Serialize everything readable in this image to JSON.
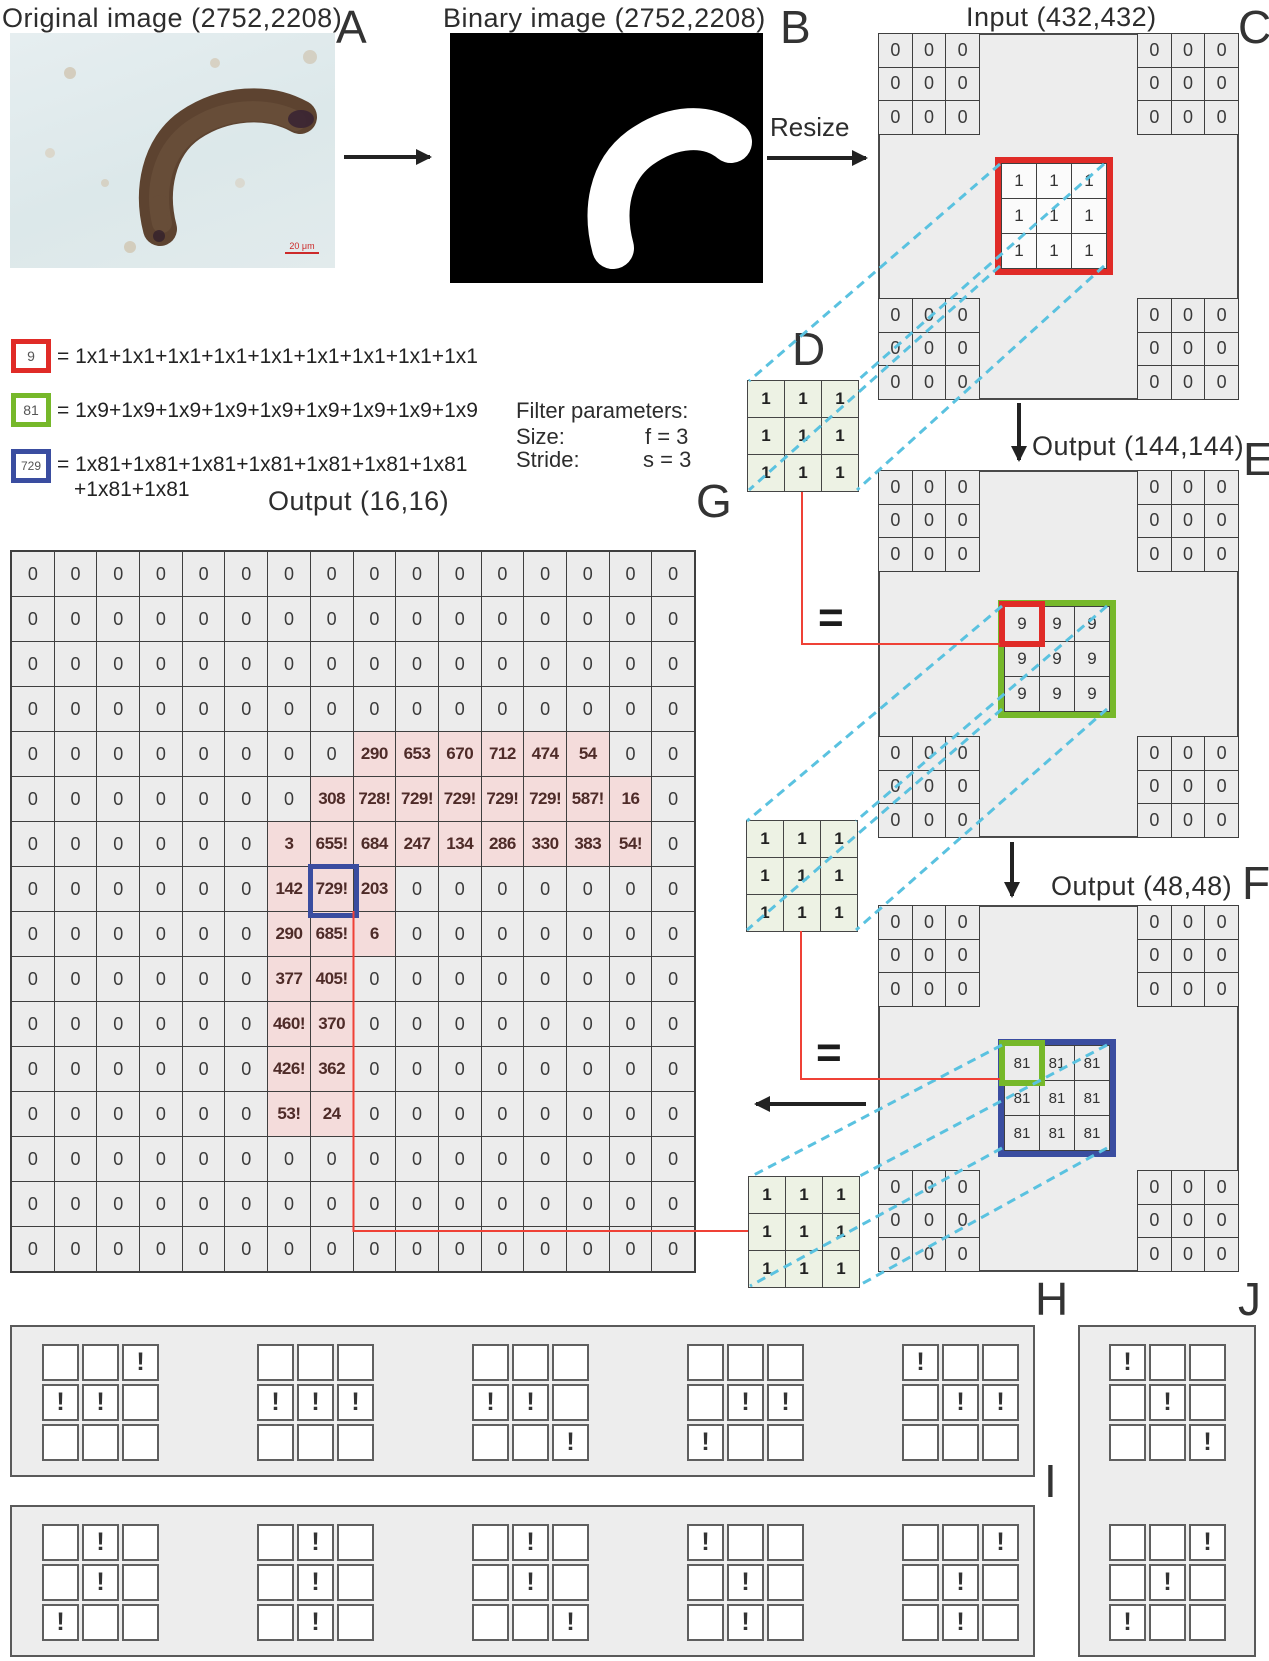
{
  "colors": {
    "red": "#e02b27",
    "green": "#76b82a",
    "blue": "#3a4da0",
    "dash": "#5ac2e0",
    "redline": "#ef4136",
    "filterbg": "#edf2e4",
    "pink": "#f4dcdb"
  },
  "exclamation": "!",
  "panel_a": {
    "title": "Original image (2752,2208)",
    "label": "A",
    "scale_bar_label": "20 μm"
  },
  "panel_b": {
    "title": "Binary image (2752,2208)",
    "label": "B"
  },
  "resize": {
    "label": "Resize"
  },
  "panel_c": {
    "title": "Input (432,432)",
    "label": "C",
    "corner_value": "0",
    "center_value": "1"
  },
  "filter_d": {
    "label": "D"
  },
  "filters_bank": {
    "value": "1"
  },
  "filter_params": {
    "heading": "Filter parameters:",
    "size_label": "Size:",
    "size_value": "f = 3",
    "stride_label": "Stride:",
    "stride_value": "s = 3"
  },
  "legend": {
    "items": [
      {
        "box": "9",
        "equation": "= 1x1+1x1+1x1+1x1+1x1+1x1+1x1+1x1+1x1"
      },
      {
        "box": "81",
        "equation": "= 1x9+1x9+1x9+1x9+1x9+1x9+1x9+1x9+1x9"
      },
      {
        "box": "729",
        "equation": "= 1x81+1x81+1x81+1x81+1x81+1x81+1x81",
        "equation_line2": "+1x81+1x81"
      }
    ]
  },
  "panel_e": {
    "title": "Output (144,144)",
    "label": "E",
    "corner_value": "0",
    "center_value": "9",
    "equals": "="
  },
  "panel_f": {
    "title": "Output (48,48)",
    "label": "F",
    "corner_value": "0",
    "center_value": "81",
    "equals": "="
  },
  "panel_g": {
    "title": "Output (16,16)",
    "label": "G",
    "matrix": [
      [
        "0",
        "0",
        "0",
        "0",
        "0",
        "0",
        "0",
        "0",
        "0",
        "0",
        "0",
        "0",
        "0",
        "0",
        "0",
        "0"
      ],
      [
        "0",
        "0",
        "0",
        "0",
        "0",
        "0",
        "0",
        "0",
        "0",
        "0",
        "0",
        "0",
        "0",
        "0",
        "0",
        "0"
      ],
      [
        "0",
        "0",
        "0",
        "0",
        "0",
        "0",
        "0",
        "0",
        "0",
        "0",
        "0",
        "0",
        "0",
        "0",
        "0",
        "0"
      ],
      [
        "0",
        "0",
        "0",
        "0",
        "0",
        "0",
        "0",
        "0",
        "0",
        "0",
        "0",
        "0",
        "0",
        "0",
        "0",
        "0"
      ],
      [
        "0",
        "0",
        "0",
        "0",
        "0",
        "0",
        "0",
        "0",
        "290",
        "653",
        "670",
        "712",
        "474",
        "54",
        "0",
        "0"
      ],
      [
        "0",
        "0",
        "0",
        "0",
        "0",
        "0",
        "0",
        "308",
        "728!",
        "729!",
        "729!",
        "729!",
        "729!",
        "587!",
        "16",
        "0"
      ],
      [
        "0",
        "0",
        "0",
        "0",
        "0",
        "0",
        "3",
        "655!",
        "684",
        "247",
        "134",
        "286",
        "330",
        "383",
        "54!",
        "0"
      ],
      [
        "0",
        "0",
        "0",
        "0",
        "0",
        "0",
        "142",
        "729!",
        "203",
        "0",
        "0",
        "0",
        "0",
        "0",
        "0",
        "0"
      ],
      [
        "0",
        "0",
        "0",
        "0",
        "0",
        "0",
        "290",
        "685!",
        "6",
        "0",
        "0",
        "0",
        "0",
        "0",
        "0",
        "0"
      ],
      [
        "0",
        "0",
        "0",
        "0",
        "0",
        "0",
        "377",
        "405!",
        "0",
        "0",
        "0",
        "0",
        "0",
        "0",
        "0",
        "0"
      ],
      [
        "0",
        "0",
        "0",
        "0",
        "0",
        "0",
        "460!",
        "370",
        "0",
        "0",
        "0",
        "0",
        "0",
        "0",
        "0",
        "0"
      ],
      [
        "0",
        "0",
        "0",
        "0",
        "0",
        "0",
        "426!",
        "362",
        "0",
        "0",
        "0",
        "0",
        "0",
        "0",
        "0",
        "0"
      ],
      [
        "0",
        "0",
        "0",
        "0",
        "0",
        "0",
        "53!",
        "24",
        "0",
        "0",
        "0",
        "0",
        "0",
        "0",
        "0",
        "0"
      ],
      [
        "0",
        "0",
        "0",
        "0",
        "0",
        "0",
        "0",
        "0",
        "0",
        "0",
        "0",
        "0",
        "0",
        "0",
        "0",
        "0"
      ],
      [
        "0",
        "0",
        "0",
        "0",
        "0",
        "0",
        "0",
        "0",
        "0",
        "0",
        "0",
        "0",
        "0",
        "0",
        "0",
        "0"
      ],
      [
        "0",
        "0",
        "0",
        "0",
        "0",
        "0",
        "0",
        "0",
        "0",
        "0",
        "0",
        "0",
        "0",
        "0",
        "0",
        "0"
      ]
    ],
    "highlight_ranges": {
      "4": [
        8,
        13
      ],
      "5": [
        7,
        14
      ],
      "6": [
        6,
        14
      ],
      "7": [
        6,
        8
      ],
      "8": [
        6,
        8
      ],
      "9": [
        6,
        7
      ],
      "10": [
        6,
        7
      ],
      "11": [
        6,
        7
      ],
      "12": [
        6,
        7
      ]
    },
    "blue_box_cell": {
      "row": 7,
      "col": 7
    }
  },
  "panel_h": {
    "label": "H",
    "patterns": [
      [
        0,
        0,
        1,
        1,
        1,
        0,
        0,
        0,
        0
      ],
      [
        0,
        0,
        0,
        1,
        1,
        1,
        0,
        0,
        0
      ],
      [
        0,
        0,
        0,
        1,
        1,
        0,
        0,
        0,
        1
      ],
      [
        0,
        0,
        0,
        0,
        1,
        1,
        1,
        0,
        0
      ],
      [
        1,
        0,
        0,
        0,
        1,
        1,
        0,
        0,
        0
      ]
    ]
  },
  "panel_i": {
    "label": "I",
    "patterns": [
      [
        0,
        1,
        0,
        0,
        1,
        0,
        1,
        0,
        0
      ],
      [
        0,
        1,
        0,
        0,
        1,
        0,
        0,
        1,
        0
      ],
      [
        0,
        1,
        0,
        0,
        1,
        0,
        0,
        0,
        1
      ],
      [
        1,
        0,
        0,
        0,
        1,
        0,
        0,
        1,
        0
      ],
      [
        0,
        0,
        1,
        0,
        1,
        0,
        0,
        1,
        0
      ]
    ]
  },
  "panel_j": {
    "label": "J",
    "patterns": [
      [
        1,
        0,
        0,
        0,
        1,
        0,
        0,
        0,
        1
      ],
      [
        0,
        0,
        1,
        0,
        1,
        0,
        1,
        0,
        0
      ]
    ]
  }
}
